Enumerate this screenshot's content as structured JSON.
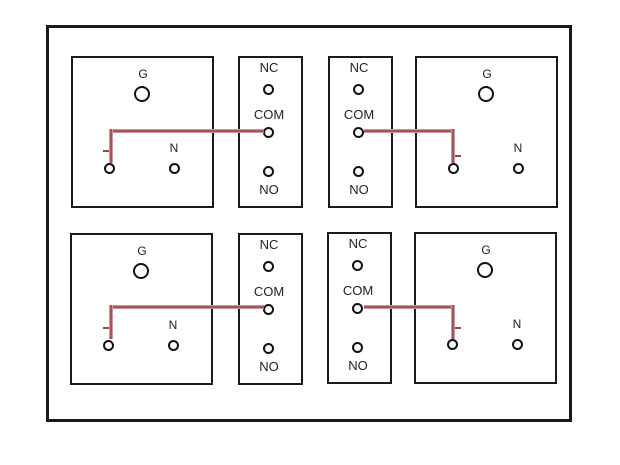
{
  "diagram": {
    "type": "relay-to-outlet wiring diagram",
    "outlets": [
      {
        "position": "top-left",
        "ground_label": "G",
        "neutral_label": "N"
      },
      {
        "position": "top-right",
        "ground_label": "G",
        "neutral_label": "N"
      },
      {
        "position": "bottom-left",
        "ground_label": "G",
        "neutral_label": "N"
      },
      {
        "position": "bottom-right",
        "ground_label": "G",
        "neutral_label": "N"
      }
    ],
    "relays": [
      {
        "position": "top-left",
        "nc_label": "NC",
        "com_label": "COM",
        "no_label": "NO"
      },
      {
        "position": "top-right",
        "nc_label": "NC",
        "com_label": "COM",
        "no_label": "NO"
      },
      {
        "position": "bottom-left",
        "nc_label": "NC",
        "com_label": "COM",
        "no_label": "NO"
      },
      {
        "position": "bottom-right",
        "nc_label": "NC",
        "com_label": "COM",
        "no_label": "NO"
      }
    ],
    "connections": [
      {
        "from": "relay-1 COM",
        "to": "outlet-top-left hot terminal"
      },
      {
        "from": "relay-2 COM",
        "to": "outlet-top-right hot terminal"
      },
      {
        "from": "relay-3 COM",
        "to": "outlet-bottom-left hot terminal"
      },
      {
        "from": "relay-4 COM",
        "to": "outlet-bottom-right hot terminal"
      }
    ],
    "colors": {
      "wire": "#9c4247",
      "wire_highlight": "#c99a9c",
      "outline": "#1a1a1a",
      "background": "#ffffff"
    }
  }
}
